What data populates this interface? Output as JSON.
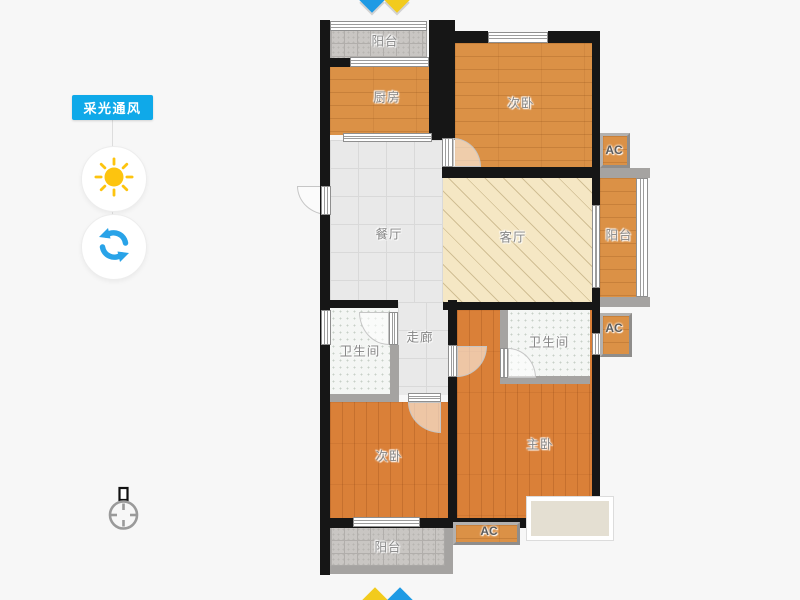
{
  "sidebar": {
    "tool_label": "采光通风",
    "accent_color": "#0fa9e9",
    "sun_color": "#fdc40f",
    "refresh_color": "#29a3e8"
  },
  "compass": {
    "top": {
      "left_color": "#1e9ae4",
      "right_color": "#f2cb1d"
    },
    "bottom": {
      "left_color": "#f2cb1d",
      "right_color": "#1e9ae4"
    }
  },
  "rooms": {
    "balcony_top": {
      "label": "阳台"
    },
    "kitchen": {
      "label": "厨房"
    },
    "bedroom_top": {
      "label": "次卧"
    },
    "dining": {
      "label": "餐厅"
    },
    "living": {
      "label": "客厅"
    },
    "balcony_right": {
      "label": "阳台"
    },
    "corridor": {
      "label": "走廊"
    },
    "bath_left": {
      "label": "卫生间"
    },
    "bath_right": {
      "label": "卫生间"
    },
    "bedroom_bottom": {
      "label": "次卧"
    },
    "master": {
      "label": "主卧"
    },
    "balcony_bottom": {
      "label": "阳台"
    }
  },
  "ac_units": {
    "top": {
      "label": "AC"
    },
    "right": {
      "label": "AC"
    },
    "bottom": {
      "label": "AC"
    }
  },
  "colors": {
    "wall": "#161616",
    "wall_light": "#a5a3a1",
    "wood_floor": "#db9146",
    "wood_floor_warm": "#da8038",
    "balcony_tile": "#c9c6c3",
    "dining_tile": "#e9e9e9",
    "living_hatch": "#f5e7c4",
    "bath_tile": "#f4f6f4",
    "bay_window": "#e4dfd2",
    "room_label": "#858585"
  }
}
